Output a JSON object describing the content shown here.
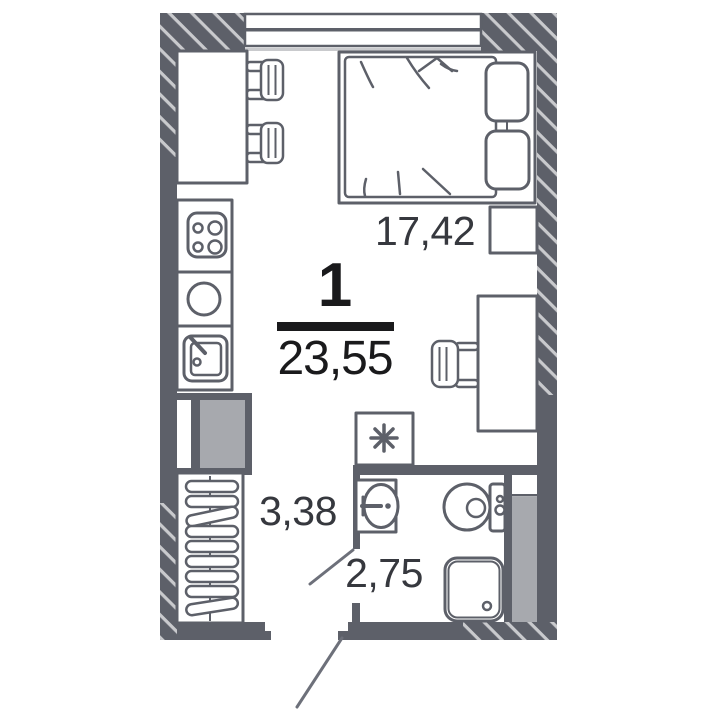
{
  "floor_plan": {
    "summary": {
      "rooms_count": "1",
      "total_area_sqm": "23,55"
    },
    "room_areas": {
      "living_room_sqm": "17,42",
      "hallway_sqm": "3,38",
      "bathroom_sqm": "2,75"
    },
    "icons": {
      "washing_machine_icon": "square with asterisk",
      "hob_icon": "4-burner cooktop circles",
      "kitchen_round_sink_icon": "circle basin",
      "kitchen_sink_icon": "square basin with tap",
      "bathroom_sink_icon": "oval basin with tap",
      "toilet_icon": "toilet bowl with cistern",
      "shower_tray_icon": "rounded square with drain",
      "wardrobe_icon": "rail with hangers",
      "bed_icon": "double bed with two pillows",
      "desk_chair_icon": "slatted chair",
      "bar_stool_icon": "slatted stool",
      "window_icon": "double-pane window strip",
      "door_swing_icon": "diagonal door leaf line"
    },
    "colors": {
      "wall": "#5d6069",
      "hatch_line": "#c9cacd",
      "shaft_fill": "#a7a9ae",
      "fridge_fill": "#a7a9ae",
      "door_line": "#6d707a",
      "summary_text": "#1a1a1c",
      "area_text": "#36383e",
      "background": "#ffffff"
    }
  }
}
